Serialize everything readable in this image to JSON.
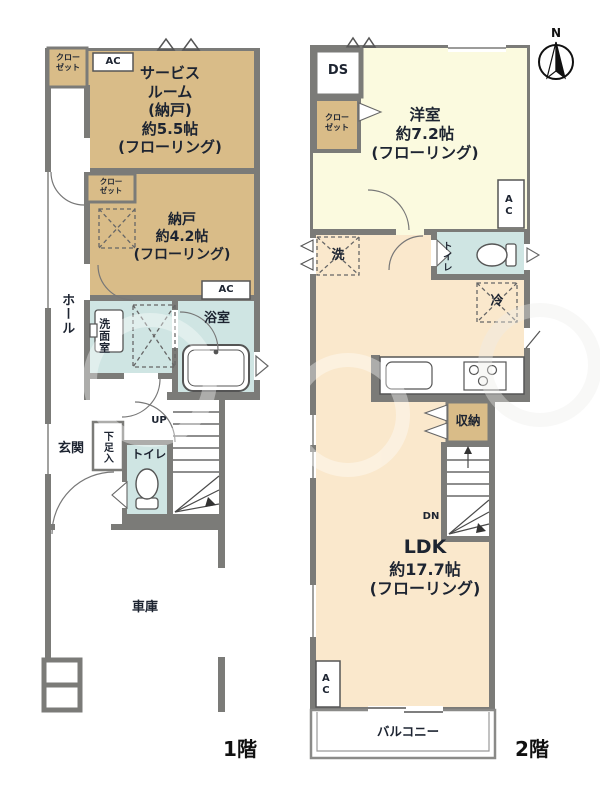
{
  "colors": {
    "wall": "#7b7b78",
    "room_tan": "#d9bc88",
    "room_pale_yellow": "#fbfadf",
    "room_beige": "#fae8cc",
    "wet_area_blue": "#cfe5e3"
  },
  "floor1": {
    "floor_label": "1階",
    "closet_top_lines": [
      "クロー",
      "ゼット"
    ],
    "ac_top": "AC",
    "service_room_lines": [
      "サービス",
      "ルーム",
      "(納戸)",
      "約5.5帖",
      "(フローリング)"
    ],
    "closet_mid_lines": [
      "クロー",
      "ゼット"
    ],
    "nando_lines": [
      "納戸",
      "約4.2帖",
      "(フローリング)"
    ],
    "hall": "ホール",
    "ac_mid": "AC",
    "washroom": "洗面室",
    "bathroom": "浴室",
    "up": "UP",
    "genkan": "玄関",
    "shoe_cabinet": "下足入",
    "toilet": "トイレ",
    "garage": "車庫"
  },
  "floor2": {
    "floor_label": "2階",
    "compass_north": "N",
    "ds": "DS",
    "closet_lines": [
      "クロー",
      "ゼット"
    ],
    "western_room_lines": [
      "洋室",
      "約7.2帖",
      "(フローリング)"
    ],
    "ac_right": "AC",
    "laundry": "洗",
    "toilet": "トイレ",
    "fridge": "冷",
    "storage": "収納",
    "dn": "DN",
    "ldk_lines": [
      "LDK",
      "約17.7帖",
      "(フローリング)"
    ],
    "ac_left": "AC",
    "balcony": "バルコニー"
  }
}
